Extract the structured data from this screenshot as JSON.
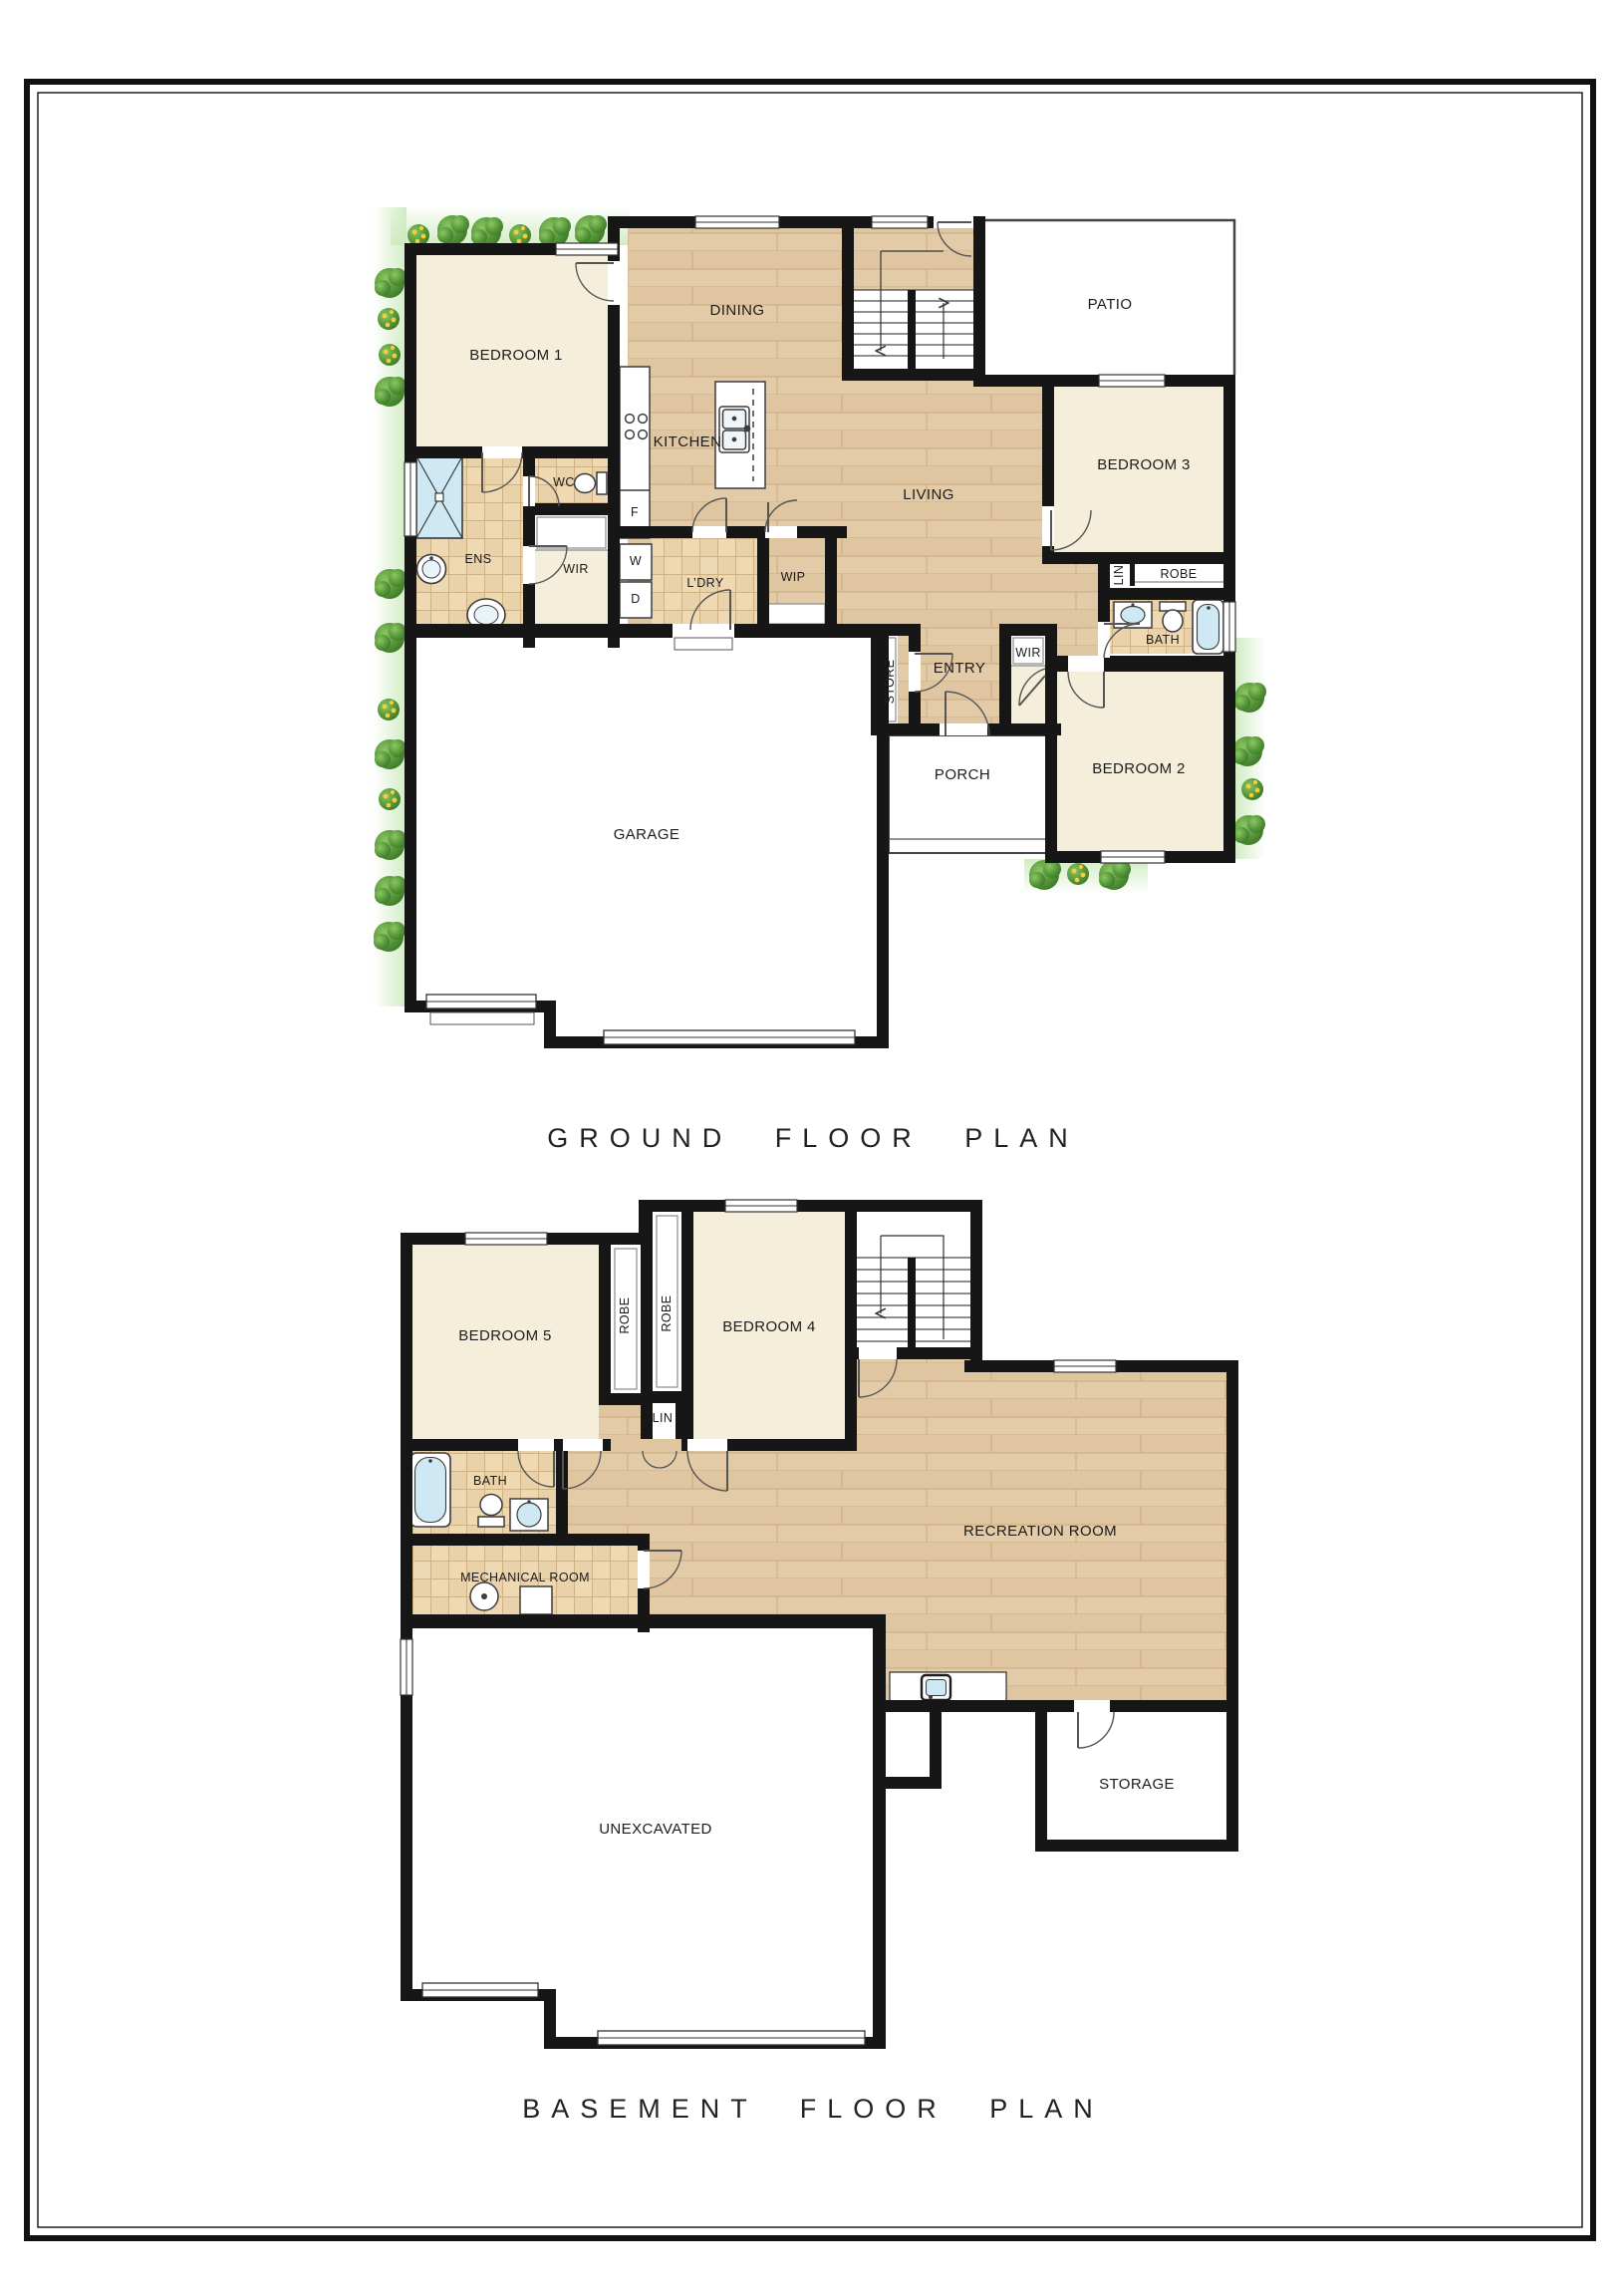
{
  "titles": {
    "ground": "GROUND FLOOR PLAN",
    "basement": "BASEMENT FLOOR PLAN"
  },
  "ground_floor": {
    "rooms": {
      "bedroom1": "BEDROOM 1",
      "dining": "DINING",
      "patio": "PATIO",
      "kitchen": "KITCHEN",
      "living": "LIVING",
      "bedroom3": "BEDROOM 3",
      "wc": "WC",
      "fridge": "F",
      "ens": "ENS",
      "wir": "WIR",
      "washer": "W",
      "dryer": "D",
      "laundry": "L’DRY",
      "wip": "WIP",
      "linen": "LIN",
      "robe": "ROBE",
      "bath": "BATH",
      "store": "STORE",
      "entry": "ENTRY",
      "wir2": "WIR",
      "bedroom2": "BEDROOM 2",
      "porch": "PORCH",
      "garage": "GARAGE"
    }
  },
  "basement": {
    "rooms": {
      "bedroom5": "BEDROOM 5",
      "robe1": "ROBE",
      "robe2": "ROBE",
      "bedroom4": "BEDROOM 4",
      "linen": "LIN",
      "bath": "BATH",
      "mechanical": "MECHANICAL ROOM",
      "recreation": "RECREATION ROOM",
      "storage": "STORAGE",
      "unexcavated": "UNEXCAVATED"
    }
  },
  "colors": {
    "wall": "#161616",
    "wood_floor": "#e3cba8",
    "tile_floor": "#e9d2a9",
    "carpet_cream": "#f4eeda",
    "water_fixture": "#cfe9f4",
    "greenery": "#4f8f38",
    "page_border": "#111111"
  }
}
